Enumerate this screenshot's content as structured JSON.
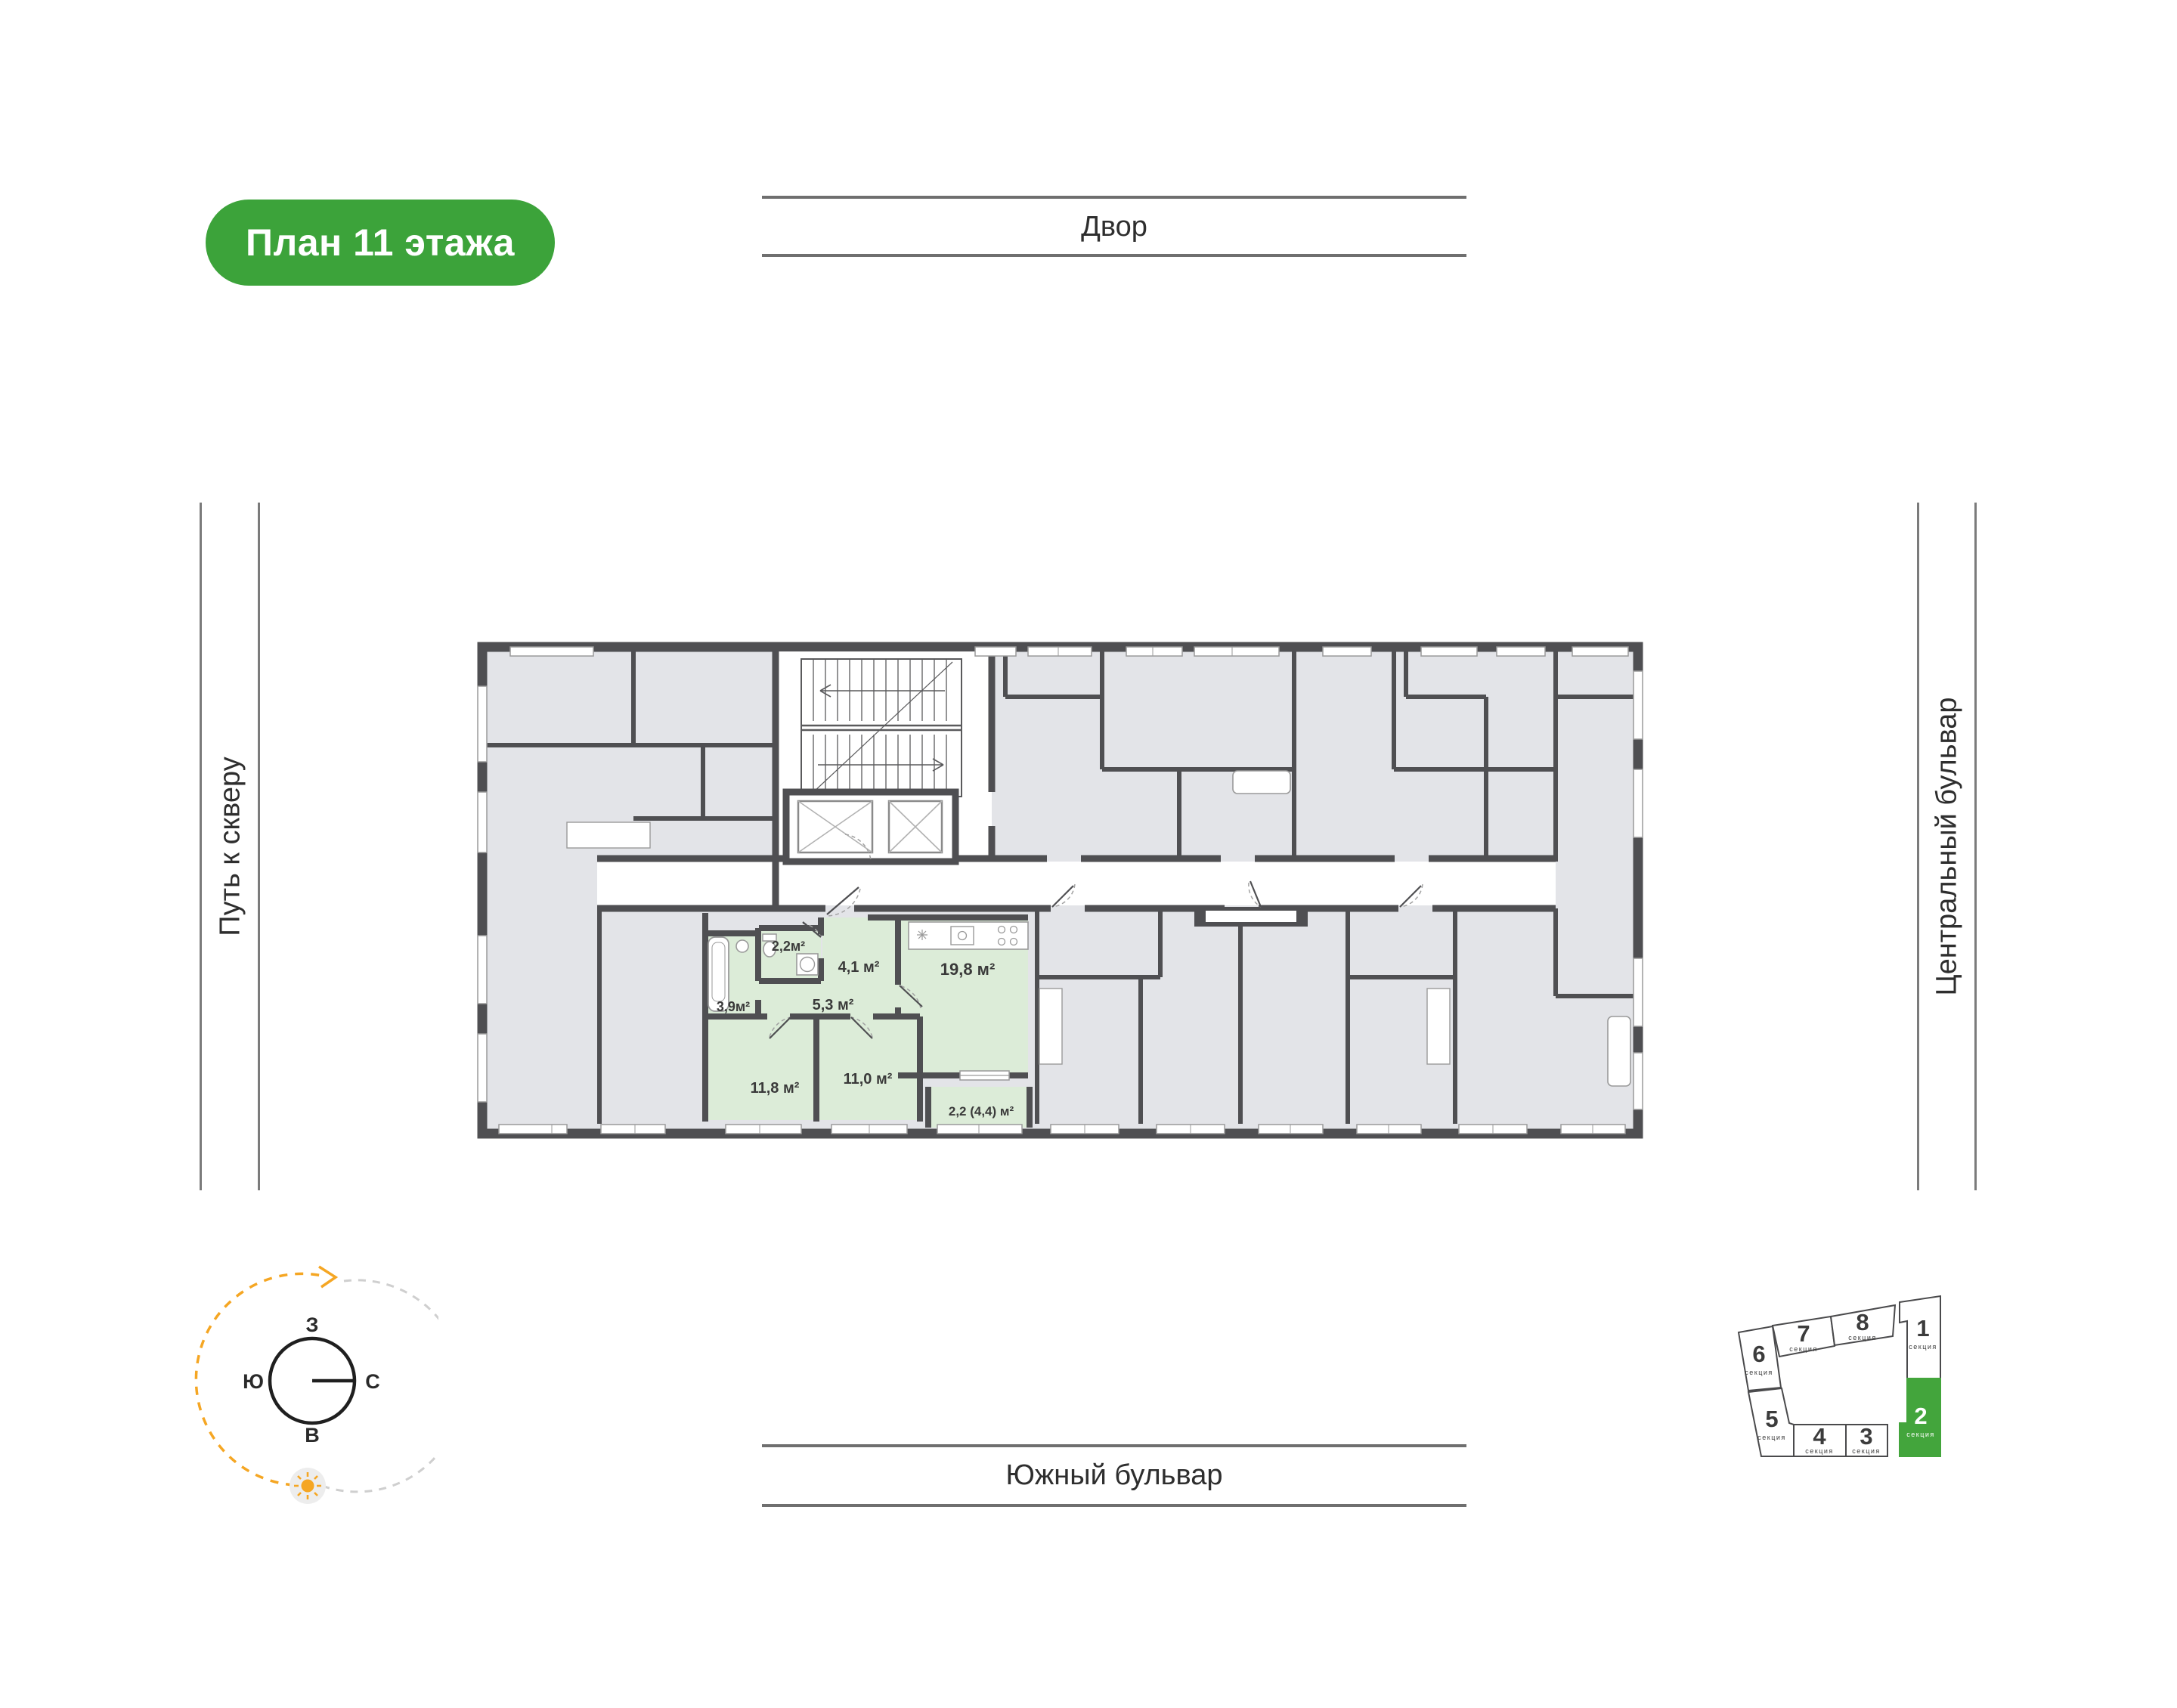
{
  "title_badge": "План 11 этажа",
  "streets": {
    "top": "Двор",
    "bottom": "Южный бульвар",
    "left": "Путь к скверу",
    "right": "Центральный бульвар"
  },
  "compass": {
    "top": "З",
    "left": "Ю",
    "right": "С",
    "bottom": "В"
  },
  "plan": {
    "highlighted_apartment": "2-комнатная, секция 2",
    "rooms": [
      {
        "id": "bathroom-2",
        "area": "2,2м²"
      },
      {
        "id": "hallway",
        "area": "4,1 м²"
      },
      {
        "id": "kitchen-living",
        "area": "19,8 м²"
      },
      {
        "id": "bathroom-1",
        "area": "3,9м²"
      },
      {
        "id": "hall",
        "area": "5,3 м²"
      },
      {
        "id": "bedroom-1",
        "area": "11,8 м²"
      },
      {
        "id": "bedroom-2",
        "area": "11,0 м²"
      },
      {
        "id": "balcony",
        "area": "2,2 (4,4) м²"
      }
    ]
  },
  "sections": [
    {
      "num": "1",
      "label": "секция",
      "active": false
    },
    {
      "num": "2",
      "label": "секция",
      "active": true
    },
    {
      "num": "3",
      "label": "секция",
      "active": false
    },
    {
      "num": "4",
      "label": "секция",
      "active": false
    },
    {
      "num": "5",
      "label": "секция",
      "active": false
    },
    {
      "num": "6",
      "label": "секция",
      "active": false
    },
    {
      "num": "7",
      "label": "секция",
      "active": false
    },
    {
      "num": "8",
      "label": "секция",
      "active": false
    }
  ],
  "colors": {
    "accent_green": "#3CA33A",
    "section_green": "#43A53C",
    "apartment_green": "#dcecd8",
    "room_gray": "#e3e4e8",
    "wall": "#4f4f52",
    "orange": "#F5A623"
  }
}
